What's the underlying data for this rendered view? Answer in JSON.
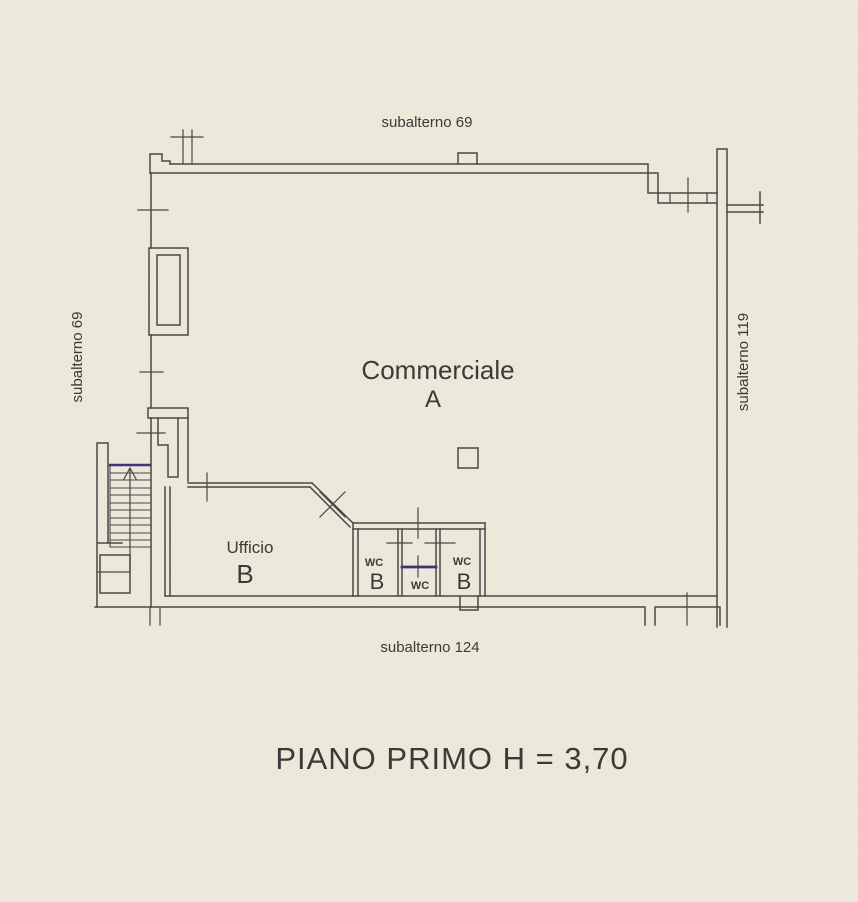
{
  "document": {
    "type": "floor-plan-scan",
    "title": "PIANO PRIMO H = 3,70",
    "labels": {
      "top": "subalterno 69",
      "left": "subalterno 69",
      "right": "subalterno 119",
      "bottom": "subalterno 124"
    },
    "rooms": {
      "commerciale": {
        "name": "Commerciale",
        "letter": "A"
      },
      "ufficio": {
        "name": "Ufficio",
        "letter": "B"
      },
      "wc_left": {
        "name": "WC",
        "letter": "B"
      },
      "wc_middle": {
        "name": "WC"
      },
      "wc_right": {
        "name": "WC",
        "letter": "B"
      }
    },
    "colors": {
      "paper": "#EDE9DB",
      "line": "#4A4846",
      "text": "#3C3A38",
      "accent": "#3A3575"
    }
  }
}
